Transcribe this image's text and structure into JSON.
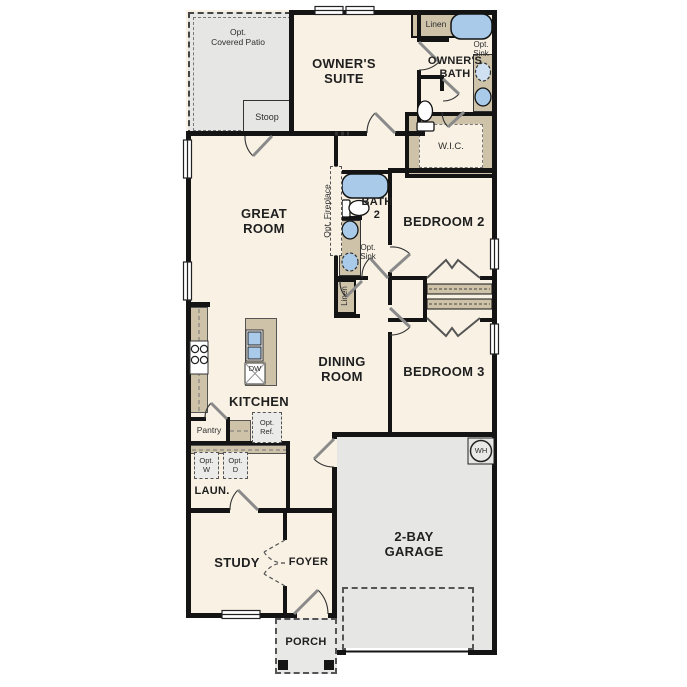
{
  "plan_type": "single-story floor plan",
  "colors": {
    "floor": "#f8f1e4",
    "wall": "#141414",
    "optional_area_gray": "#e6e6e4",
    "cabinet_tan": "#cec2a9",
    "fixture_blue": "#a9cae9"
  },
  "rooms": {
    "covered_patio": "Opt.\nCovered Patio",
    "stoop": "Stoop",
    "owners_suite": "OWNER'S\nSUITE",
    "linen_owners": "Linen",
    "owners_bath": "OWNER'S\nBATH",
    "opt_sink_owners": "Opt.\nSink",
    "wic": "W.I.C.",
    "great_room": "GREAT\nROOM",
    "opt_fireplace": "Opt. Fireplace",
    "bath2": "BATH\n2",
    "opt_sink_bath2": "Opt.\nSink",
    "linen_hall": "Linen",
    "bedroom2": "BEDROOM 2",
    "dining_room": "DINING\nROOM",
    "bedroom3": "BEDROOM 3",
    "kitchen": "KITCHEN",
    "dishwasher": "DW",
    "pantry": "Pantry",
    "opt_ref": "Opt.\nRef.",
    "opt_washer": "Opt.\nW",
    "opt_dryer": "Opt.\nD",
    "laundry": "LAUN.",
    "study": "STUDY",
    "foyer": "FOYER",
    "garage": "2-BAY\nGARAGE",
    "water_heater": "WH",
    "porch": "PORCH"
  }
}
